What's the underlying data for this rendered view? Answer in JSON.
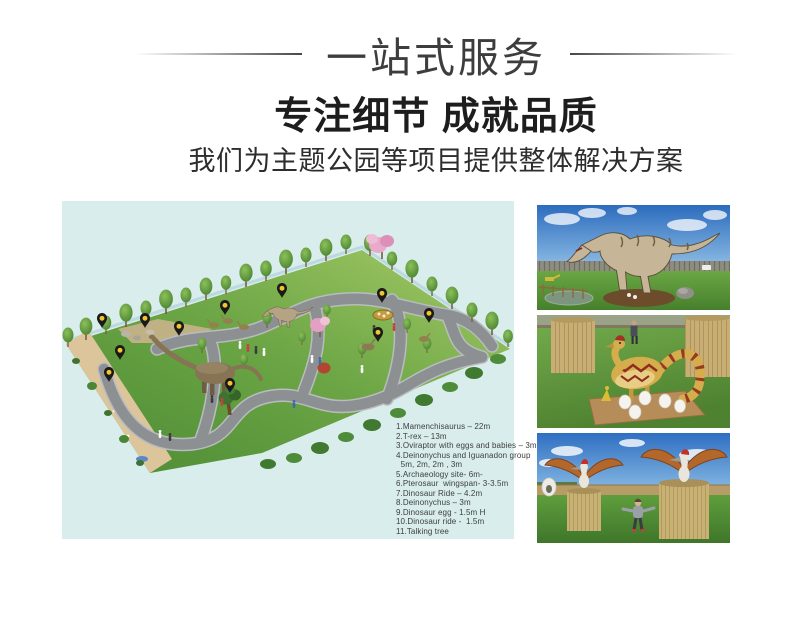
{
  "header": {
    "title": "一站式服务",
    "subtitle": "专注细节 成就品质",
    "tagline": "我们为主题公园等项目提供整体解决方案"
  },
  "park_plan": {
    "background_color": "#d8edec",
    "pin_color": "#1a1a1a",
    "pin_dot_color": "#f2c52e",
    "legend_lines": [
      "1.Mamenchisaurus – 22m",
      "2.T-rex – 13m",
      "3.Oviraptor with eggs and babies – 3m",
      "4.Deinonychus and Iguanadon group",
      "  5m, 2m, 2m , 3m",
      "5.Archaeology site- 6m-",
      "6.Pterosaur  wingspan- 3-3.5m",
      "7.Dinosaur Ride – 4.2m",
      "8.Deinonychus – 3m",
      "9.Dinosaur egg - 1.5m H",
      "10.Dinosaur ride -  1.5m",
      "11.Talking tree"
    ]
  }
}
